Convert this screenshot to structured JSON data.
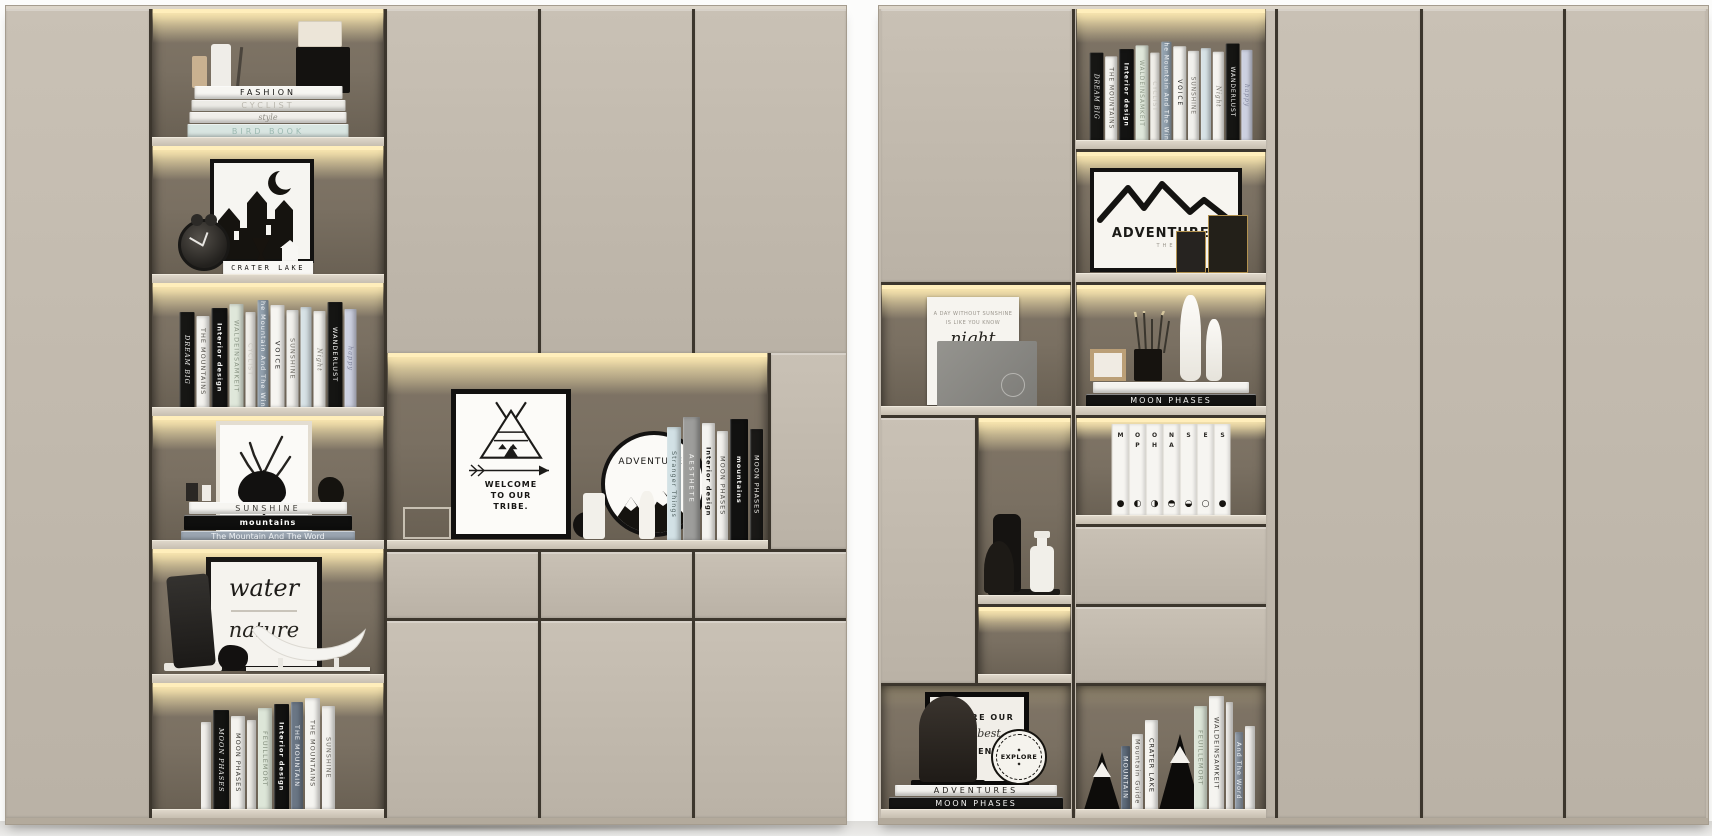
{
  "scene": {
    "description": "Two beige built-in cabinet units with warm-lit open display niches, closed doors and drawers",
    "colors": {
      "cabinet": "#c1b9ad",
      "cabinet_gap": "#3c362d",
      "niche_top": "#93876f",
      "niche_bottom": "#685f52",
      "led_glow": "#ffeebb",
      "shelf_board": "#d6cfc2",
      "floor": "#e6e5e2",
      "wall": "#fcfcfb",
      "book_black": "#141413",
      "book_white": "#f4f3ef",
      "book_sage": "#dde6d8",
      "book_blue": "#8e99a6",
      "gold_trim": "#b3924f"
    }
  },
  "left": {
    "row1": {
      "stack": [
        {
          "title": "FASHION",
          "bg": "#f7f6f2",
          "fg": "#151412",
          "w": 148,
          "h": 13,
          "ls": 3
        },
        {
          "title": "CYCLIST",
          "bg": "#ecebe6",
          "fg": "#b9b6ad",
          "w": 154,
          "h": 11,
          "ls": 3
        },
        {
          "title": "style",
          "bg": "#f1efeb",
          "fg": "#8f8c84",
          "w": 157,
          "h": 11,
          "script": true
        },
        {
          "title": "BIRD BOOK",
          "bg": "#d8e5e1",
          "fg": "#9cb9b1",
          "w": 161,
          "h": 14,
          "ls": 3
        }
      ]
    },
    "row2": {
      "plaque": "CRATER LAKE"
    },
    "row3": {
      "books": [
        {
          "title": "DREAM BIG",
          "bg": "#161614",
          "fg": "#f2f2f0",
          "w": 15,
          "h": 96,
          "script": true
        },
        {
          "title": "THE MOUNTAINS",
          "bg": "#f3f2ee",
          "fg": "#55524c",
          "w": 13,
          "h": 92
        },
        {
          "title": "Interior design",
          "bg": "#131312",
          "fg": "#fafaf8",
          "w": 16,
          "h": 100,
          "bold": true
        },
        {
          "title": "WALDEINSAMKEIT",
          "bg": "#dfe7da",
          "fg": "#8a9584",
          "w": 14,
          "h": 104
        },
        {
          "title": "CYCLIST",
          "bg": "#efede8",
          "fg": "#c6c3bb",
          "w": 10,
          "h": 96
        },
        {
          "title": "The Mountain And The Wind",
          "bg": "#91a0ad",
          "fg": "#f2f4f6",
          "w": 11,
          "h": 108
        },
        {
          "title": "VOICE",
          "bg": "#f6f5f1",
          "fg": "#1c1c1a",
          "w": 14,
          "h": 103,
          "ls": 2
        },
        {
          "title": "SUNSHINE",
          "bg": "#f1f0ec",
          "fg": "#6e6b64",
          "w": 12,
          "h": 98
        },
        {
          "title": "",
          "bg": "#d7e2e6",
          "fg": "#9aa7ad",
          "w": 11,
          "h": 101
        },
        {
          "title": "Night",
          "bg": "#f4f3ef",
          "fg": "#77746c",
          "w": 12,
          "h": 97,
          "script": true
        },
        {
          "title": "WANDERLUST",
          "bg": "#151513",
          "fg": "#f5f5f3",
          "w": 15,
          "h": 106
        },
        {
          "title": "happy",
          "bg": "#ccd0e0",
          "fg": "#7e829a",
          "w": 12,
          "h": 99,
          "script": true
        }
      ]
    },
    "row4": {
      "stack": [
        {
          "title": "SUNSHINE",
          "bg": "#f6f5f1",
          "fg": "#3a3833",
          "w": 158,
          "h": 12,
          "ls": 3
        },
        {
          "title": "mountains",
          "bg": "#0f0f0e",
          "fg": "#fbfbfa",
          "w": 168,
          "h": 15,
          "bold": true,
          "ls": 1
        },
        {
          "title": "The Mountain And The Word",
          "bg": "#9aa5b1",
          "fg": "#eef1f4",
          "w": 174,
          "h": 10
        }
      ]
    },
    "row5": {
      "art_word1": "water",
      "art_word2": "nature"
    },
    "row6": {
      "books": [
        {
          "title": "",
          "bg": "#f1efeb",
          "fg": "#999790",
          "w": 10,
          "h": 88
        },
        {
          "title": "MOON PHASES",
          "bg": "#141412",
          "fg": "#f3f3f1",
          "w": 16,
          "h": 100,
          "script": true
        },
        {
          "title": "MOON PHASES",
          "bg": "#f4f3ef",
          "fg": "#3a3833",
          "w": 14,
          "h": 94
        },
        {
          "title": "",
          "bg": "#eeece7",
          "fg": "#999790",
          "w": 9,
          "h": 90
        },
        {
          "title": "FEUILLEMORT",
          "bg": "#dde6d8",
          "fg": "#828d7c",
          "w": 14,
          "h": 102
        },
        {
          "title": "Interior design",
          "bg": "#121211",
          "fg": "#f8f8f6",
          "w": 15,
          "h": 106,
          "bold": true
        },
        {
          "title": "THE MOUNTAIN",
          "bg": "#6a7685",
          "fg": "#eef0f3",
          "w": 12,
          "h": 108
        },
        {
          "title": "THE MOUNTAINS",
          "bg": "#f5f4f0",
          "fg": "#55524c",
          "w": 15,
          "h": 112
        },
        {
          "title": "SUNSHINE",
          "bg": "#f2f1ed",
          "fg": "#6e6b64",
          "w": 13,
          "h": 104
        }
      ]
    },
    "niche": {
      "tipi_line1": "WELCOME",
      "tipi_line2": "TO OUR",
      "tipi_line3": "TRIBE.",
      "plate": "ADVENTURES",
      "books": [
        {
          "title": "Stranger Things",
          "bg": "#d2e1e5",
          "fg": "#50605f",
          "w": 14,
          "h": 114
        },
        {
          "title": "AESTHETE",
          "bg": "#9d9d9b",
          "fg": "#f4f4f2",
          "w": 17,
          "h": 124,
          "ls": 2
        },
        {
          "title": "Interior design",
          "bg": "#f5f4f0",
          "fg": "#141412",
          "w": 13,
          "h": 118,
          "bold": true
        },
        {
          "title": "MOON PHASES",
          "bg": "#f2f1ed",
          "fg": "#4a4844",
          "w": 11,
          "h": 110
        },
        {
          "title": "mountains",
          "bg": "#111110",
          "fg": "#f6f6f4",
          "w": 18,
          "h": 122,
          "bold": true
        },
        {
          "title": "MOON PHASES",
          "bg": "#1a1917",
          "fg": "#eceae6",
          "w": 13,
          "h": 112
        }
      ]
    }
  },
  "right": {
    "poster": {
      "line1": "A DAY WITHOUT SUNSHINE",
      "line2": "IS LIKE YOU KNOW",
      "script": "night"
    },
    "adventure_frame": {
      "title": "ADVENTURES",
      "sub": "THE"
    },
    "desk_stack": [
      {
        "title": "",
        "bg": "#f4f3ef",
        "fg": "#8a8780",
        "w": 156,
        "h": 11
      },
      {
        "title": "MOON PHASES",
        "bg": "#131312",
        "fg": "#f1f1ef",
        "w": 170,
        "h": 13,
        "ls": 2
      }
    ],
    "moonset": [
      {
        "letters": "M",
        "phase": "●"
      },
      {
        "letters": "O\nP",
        "phase": "◐"
      },
      {
        "letters": "O\nH",
        "phase": "◑"
      },
      {
        "letters": "N\nA",
        "phase": "◓"
      },
      {
        "letters": "S",
        "phase": "◒"
      },
      {
        "letters": "E",
        "phase": "○"
      },
      {
        "letters": "S",
        "phase": "●"
      }
    ],
    "bottom_left": {
      "frame_line1": "ARE OUR",
      "frame_script": "best",
      "frame_line2": "ADVENTURE",
      "badge": "EXPLORE",
      "badge_mark": "◆",
      "stack": [
        {
          "title": "ADVENTURES",
          "bg": "#f2f1ed",
          "fg": "#23211d",
          "w": 162,
          "h": 11,
          "ls": 3
        },
        {
          "title": "MOON PHASES",
          "bg": "#141413",
          "fg": "#f2f2f0",
          "w": 174,
          "h": 13,
          "ls": 2
        }
      ]
    },
    "bookends": {
      "group1": [
        {
          "title": "MOUNTAIN",
          "bg": "#606d7d",
          "fg": "#eef0f3",
          "w": 9,
          "h": 64
        },
        {
          "title": "Mountain Guide",
          "bg": "#f3f2ee",
          "fg": "#56534d",
          "w": 11,
          "h": 76
        },
        {
          "title": "CRATER LAKE",
          "bg": "#f6f5f1",
          "fg": "#1d1b18",
          "w": 13,
          "h": 90
        }
      ],
      "group2": [
        {
          "title": "FEUILLEMORT",
          "bg": "#dde6d8",
          "fg": "#828d7c",
          "w": 13,
          "h": 104
        },
        {
          "title": "WALDEINSAMKEIT",
          "bg": "#f5f4f0",
          "fg": "#3c3a35",
          "w": 15,
          "h": 114
        },
        {
          "title": "",
          "bg": "#efede9",
          "fg": "#999990",
          "w": 7,
          "h": 108
        },
        {
          "title": "And The Word",
          "bg": "#8e99a6",
          "fg": "#eef1f4",
          "w": 8,
          "h": 78
        },
        {
          "title": "",
          "bg": "#f2f1ed",
          "fg": "#999990",
          "w": 10,
          "h": 84
        }
      ]
    }
  }
}
